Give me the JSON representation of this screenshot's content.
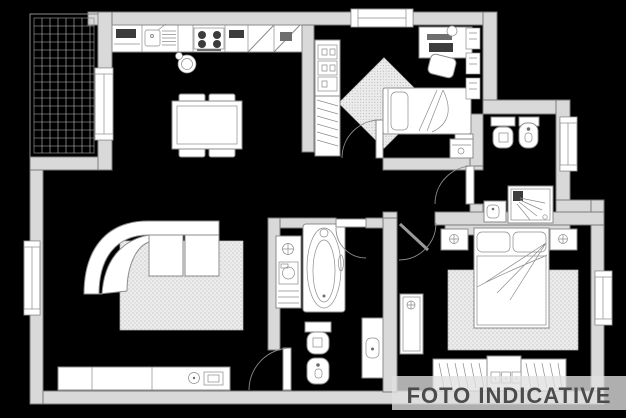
{
  "canvas": {
    "width": 626,
    "height": 418,
    "background": "#000000"
  },
  "watermark": {
    "text": "FOTO INDICATIVE"
  },
  "palette": {
    "background": "#000000",
    "wall_fill": "#d9d9d9",
    "wall_stroke": "#7a7a7a",
    "furniture_fill": "#ffffff",
    "line_color": "#8c8c8c",
    "dark_fill": "#3c3c3c",
    "grid_color": "#bdbdbd",
    "rug_base": "#ececec",
    "rug_dot": "#a3a3a3",
    "watermark_text": "#4b4b4d",
    "watermark_band": "rgba(224,224,224,0.78)"
  },
  "floorplan": {
    "type": "apartment-floor-plan",
    "rooms": [
      {
        "name": "balcony",
        "features": [
          "tiled-floor",
          "railing"
        ]
      },
      {
        "name": "kitchen-living-room",
        "features": [
          "kitchen-counter",
          "sink",
          "cooktop",
          "corner-cabinets",
          "kettle",
          "dining-table",
          "four-chairs",
          "curved-sofa",
          "rug",
          "sideboard",
          "balcony-door",
          "window"
        ]
      },
      {
        "name": "bedroom-2",
        "features": [
          "wardrobe-shelves",
          "hanging-rail",
          "single-bed",
          "nightstand",
          "desk",
          "desk-chair",
          "wall-shelves",
          "diamond-rug",
          "window"
        ]
      },
      {
        "name": "bathroom-2",
        "features": [
          "toilet",
          "bidet",
          "shower",
          "washbasin",
          "window",
          "door"
        ]
      },
      {
        "name": "hallway",
        "features": [
          "cabinet",
          "doors-to-rooms"
        ]
      },
      {
        "name": "bathroom-1",
        "features": [
          "bathtub",
          "toilet",
          "bidet",
          "washbasin-counter",
          "laundry-column",
          "door"
        ]
      },
      {
        "name": "bedroom-1",
        "features": [
          "double-bed",
          "two-nightstands",
          "rug",
          "wardrobe",
          "dresser",
          "window",
          "door"
        ]
      }
    ]
  }
}
